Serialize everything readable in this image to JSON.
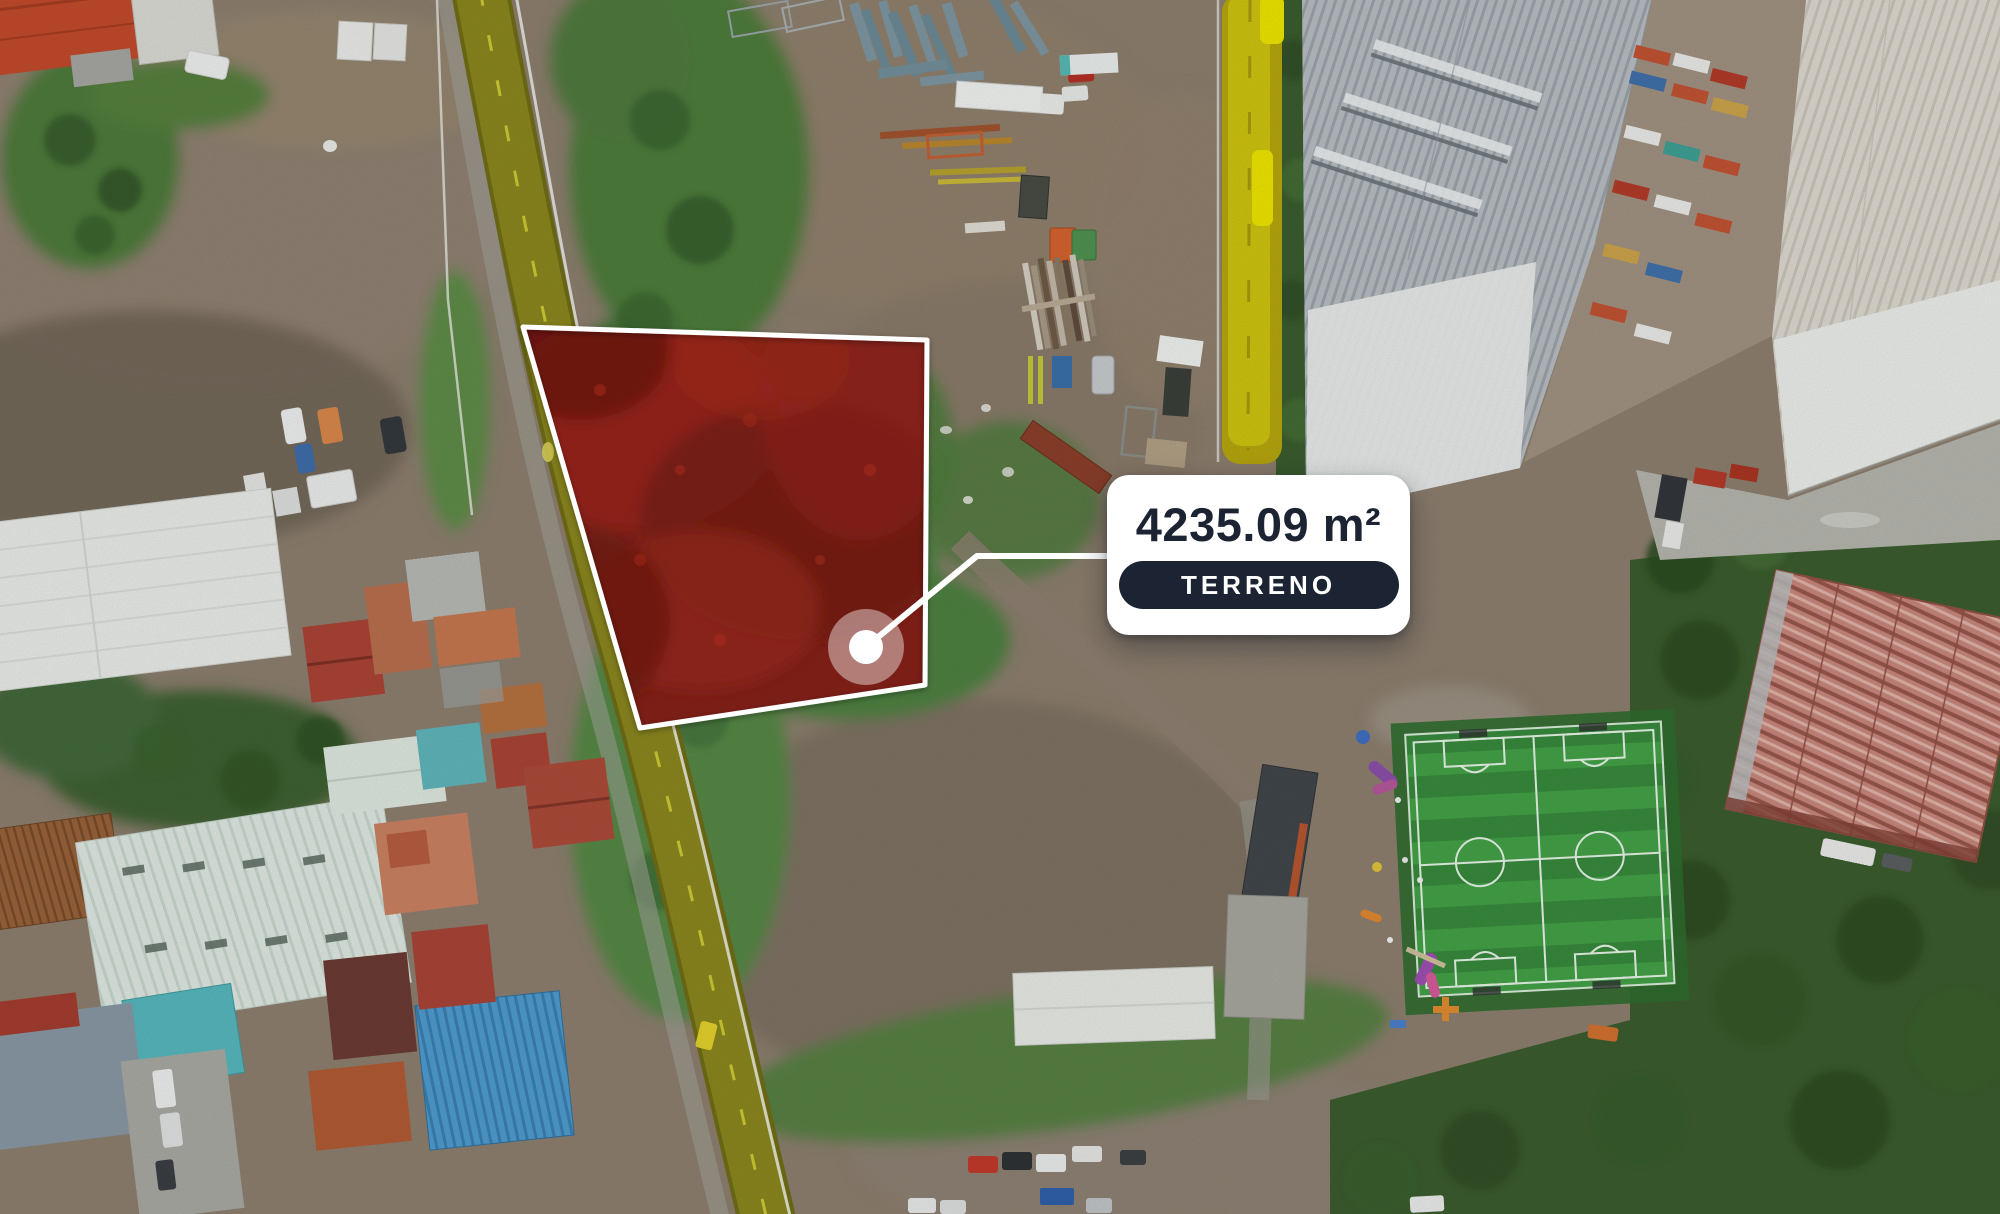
{
  "scene": {
    "width": 2000,
    "height": 1214
  },
  "parcel": {
    "points": "523,327 927,340 925,685 640,728",
    "fill": "#7a1e16",
    "stroke": "#ffffff",
    "marker": {
      "cx": 866,
      "cy": 647,
      "outer_r": 38,
      "inner_r": 17,
      "color": "#ffffff",
      "outer_opacity": 0.42
    },
    "leader_points": "866,647 977,556 1110,556",
    "leader_color": "#ffffff"
  },
  "card": {
    "area_label": "4235.09 m²",
    "badge_label": "TERRENO",
    "bg": "#ffffff",
    "text_color": "#1c2434",
    "badge_bg": "#1c2434",
    "badge_text_color": "#ffffff"
  }
}
